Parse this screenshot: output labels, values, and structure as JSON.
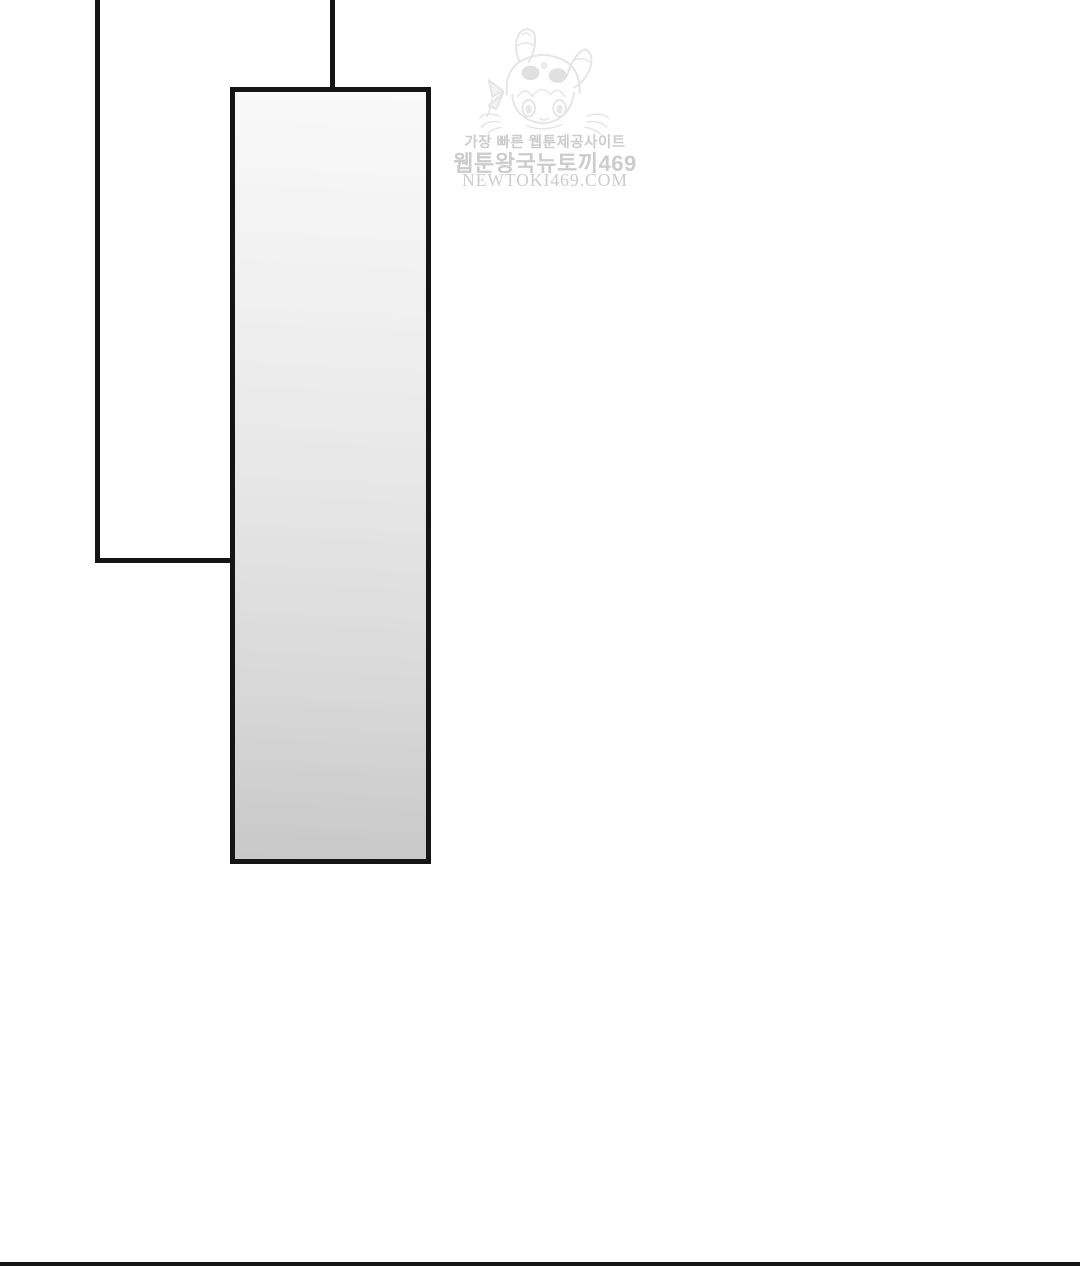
{
  "page": {
    "kind": "webtoon-comic-page",
    "background_color": "#ffffff",
    "panel_border_color": "#151515",
    "mirror_gradient_top": "#f9f9f9",
    "mirror_gradient_bottom": "#c8c8c8"
  },
  "watermark": {
    "character_icon": "bunny-hood-chibi-girl-illustration",
    "text_color": "#cccccc",
    "line1": "가장 빠른 웹툰제공사이트",
    "line2": "웹툰왕국뉴토끼469",
    "line3": "NEWTOKI469.COM"
  }
}
